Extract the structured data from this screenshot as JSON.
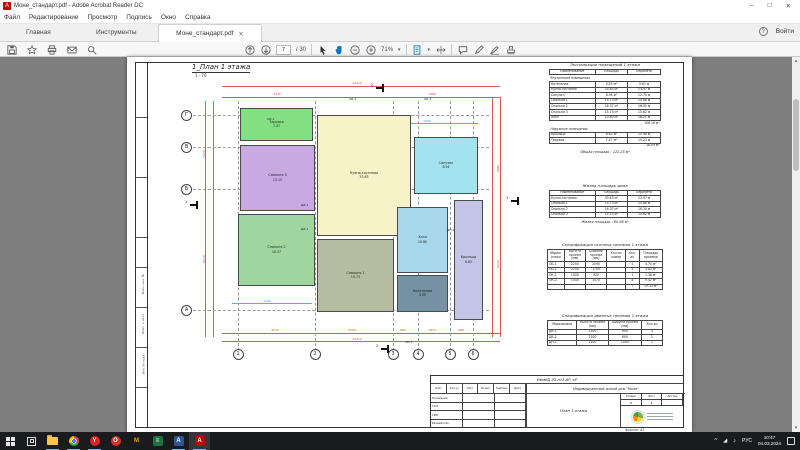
{
  "window": {
    "title": "Моне_стандарт.pdf - Adobe Acrobat Reader DC",
    "acrobat_glyph": "A",
    "controls": {
      "minimize": "–",
      "maximize": "□",
      "close": "✕"
    }
  },
  "menu": {
    "items": [
      "Файл",
      "Редактирование",
      "Просмотр",
      "Подпись",
      "Окно",
      "Справка"
    ]
  },
  "tabbar": {
    "home": "Главная",
    "tools": "Инструменты",
    "doc_tab": "Моне_стандарт.pdf",
    "close_tab": "✕",
    "help": "?",
    "sign_in": "Войти"
  },
  "toolbar": {
    "page_current": "7",
    "page_total": "/ 30",
    "zoom_level": "71%",
    "caret": "▾"
  },
  "page": {
    "title": "1_План 1 этажа",
    "scale": "1 : 70",
    "margin_labels": [
      "Взам. инв. №",
      "Подп. и дата",
      "Инв. № подл."
    ],
    "format_label": "Формат А3",
    "plan": {
      "grid_rows": [
        {
          "label": "Г",
          "y": 58
        },
        {
          "label": "В",
          "y": 90
        },
        {
          "label": "Б",
          "y": 132
        },
        {
          "label": "А",
          "y": 253
        }
      ],
      "grid_cols": [
        {
          "label": "1",
          "x": 111
        },
        {
          "label": "2",
          "x": 188
        },
        {
          "label": "3",
          "x": 266
        },
        {
          "label": "4",
          "x": 291
        },
        {
          "label": "5",
          "x": 323
        },
        {
          "label": "6",
          "x": 346
        }
      ],
      "rooms": [
        {
          "name": "Терраса",
          "area": "7.47",
          "color": "#82e082",
          "x": 113,
          "y": 51,
          "w": 73,
          "h": 33
        },
        {
          "name": "Спальня 3",
          "area": "15.15",
          "color": "#c9a9e2",
          "x": 113,
          "y": 88,
          "w": 75,
          "h": 66
        },
        {
          "name": "Спальня 2",
          "area": "16.37",
          "color": "#9fd69f",
          "x": 111,
          "y": 157,
          "w": 77,
          "h": 72
        },
        {
          "name": "Кухня-гостиная",
          "area": "33.63",
          "color": "#f7f2c8",
          "x": 190,
          "y": 58,
          "w": 94,
          "h": 121
        },
        {
          "name": "Спальня 1",
          "area": "15.73",
          "color": "#b7bda0",
          "x": 190,
          "y": 182,
          "w": 77,
          "h": 73
        },
        {
          "name": "Санузел",
          "area": "8.94",
          "color": "#a3e3ef",
          "x": 287,
          "y": 80,
          "w": 64,
          "h": 57
        },
        {
          "name": "Холл",
          "area": "10.80",
          "color": "#a8d8ec",
          "x": 270,
          "y": 150,
          "w": 51,
          "h": 66
        },
        {
          "name": "Котельная",
          "area": "5.55",
          "color": "#7691a1",
          "x": 270,
          "y": 218,
          "w": 51,
          "h": 37
        },
        {
          "name": "Крыльцо",
          "area": "8.62",
          "color": "#c5c5e8",
          "x": 327,
          "y": 143,
          "w": 29,
          "h": 120
        }
      ],
      "tags": [
        {
          "text": "ОБ-1",
          "x": 140,
          "y": 60
        },
        {
          "text": "ОБ-2",
          "x": 222,
          "y": 40
        },
        {
          "text": "ОК-2",
          "x": 297,
          "y": 40
        },
        {
          "text": "ДВ-1",
          "x": 174,
          "y": 146
        },
        {
          "text": "ДВ-1",
          "x": 174,
          "y": 170
        },
        {
          "text": "ДН-1",
          "x": 320,
          "y": 171
        },
        {
          "text": "ОК-1",
          "x": 278,
          "y": 283
        }
      ],
      "dims_top": [
        {
          "text": "12410",
          "x": 230,
          "y": 24
        },
        {
          "text": "4470",
          "x": 150,
          "y": 35
        },
        {
          "text": "7680",
          "x": 305,
          "y": 35
        }
      ],
      "dims_bottom": [
        {
          "text": "4270",
          "x": 148,
          "y": 271
        },
        {
          "text": "4190",
          "x": 225,
          "y": 271
        },
        {
          "text": "660",
          "x": 276,
          "y": 271
        },
        {
          "text": "1870",
          "x": 305,
          "y": 271
        },
        {
          "text": "660",
          "x": 334,
          "y": 271
        },
        {
          "text": "12410",
          "x": 230,
          "y": 280
        }
      ],
      "dims_left": [
        {
          "text": "5470",
          "x": 73,
          "y": 95
        },
        {
          "text": "9570",
          "x": 73,
          "y": 200
        }
      ],
      "dims_right": [
        {
          "text": "1880",
          "x": 367,
          "y": 110
        },
        {
          "text": "9130",
          "x": 367,
          "y": 205
        }
      ],
      "dims_cyan": [
        {
          "text": "1500",
          "x": 300,
          "y": 62
        },
        {
          "text": "1440",
          "x": 140,
          "y": 242
        }
      ],
      "section_markers": [
        {
          "label": "2",
          "x": 249,
          "y": 27
        },
        {
          "label": "2",
          "x": 254,
          "y": 288
        },
        {
          "label": "1",
          "x": 63,
          "y": 144
        },
        {
          "label": "1",
          "x": 384,
          "y": 140
        }
      ]
    },
    "tables": [
      {
        "id": "explication",
        "x": 422,
        "y": 6,
        "w": 112,
        "title": "Экспликация помещений 1 этажа",
        "columns": [
          "Наименование",
          "Площадь",
          "Периметр"
        ],
        "widths": [
          46,
          33,
          33
        ],
        "sections": [
          {
            "label": "Внутренние помещения",
            "rows": [
              [
                "Котельная",
                "5.55 м²",
                "9.61 м"
              ],
              [
                "Кухня-гостиная",
                "33.63 м²",
                "23.97 м"
              ],
              [
                "Санузел",
                "8.94 м²",
                "12.70 м"
              ],
              [
                "Спальня 1",
                "15.73 м²",
                "15.86 м"
              ],
              [
                "Спальня 2",
                "16.37 м²",
                "16.30 м"
              ],
              [
                "Спальня 3",
                "15.15 м²",
                "15.62 м"
              ],
              [
                "Холл",
                "10.80 м²",
                "18.21 м"
              ]
            ],
            "subtotal": "106.16 м²"
          },
          {
            "label": "Наружные помещения",
            "rows": [
              [
                "Крыльцо",
                "8.62 м²",
                "15.98 м"
              ],
              [
                "Терраса",
                "7.47 м²",
                "10.23 м"
              ]
            ],
            "subtotal": "16.09 м²"
          }
        ],
        "total_label": "Общая площадь :",
        "total_value": "122.25 м²"
      },
      {
        "id": "living",
        "x": 422,
        "y": 127,
        "w": 112,
        "title": "Жилая площадь дома",
        "columns": [
          "Наименование",
          "Площадь",
          "Периметр"
        ],
        "widths": [
          46,
          33,
          33
        ],
        "sections": [
          {
            "rows": [
              [
                "Кухня-гостиная",
                "33.63 м²",
                "23.97 м"
              ],
              [
                "Спальня 1",
                "15.73 м²",
                "15.86 м"
              ],
              [
                "Спальня 2",
                "16.37 м²",
                "16.30 м"
              ],
              [
                "Спальня 3",
                "15.15 м²",
                "15.62 м"
              ]
            ]
          }
        ],
        "total_label": "Жилая площадь :",
        "total_value": "80.88 м²"
      },
      {
        "id": "windows",
        "x": 420,
        "y": 186,
        "w": 116,
        "title": "Спецификация оконных проемов 1 этажа",
        "columns": [
          "Марки- ровка",
          "Высота проема (мм)",
          "Ширина проема (мм)",
          "Кол-во камер",
          "Кол- во",
          "Площадь проемов"
        ],
        "widths": [
          15,
          19,
          19,
          17,
          12,
          21
        ],
        "sections": [
          {
            "rows": [
              [
                "ОБ-1",
                "2250",
                "2090",
                "",
                "1",
                "4.70 м²"
              ],
              [
                "ОБ-2",
                "2250",
                "1700",
                "",
                "1",
                "3.83 м²"
              ],
              [
                "ОК-1",
                "1500",
                "920",
                "",
                "1",
                "1.38 м²"
              ],
              [
                "ОК-2",
                "1500",
                "1570",
                "",
                "4",
                "9.42 м²"
              ]
            ]
          }
        ],
        "totals_row": [
          "",
          "",
          "",
          "",
          "7",
          "19.33 м²"
        ]
      },
      {
        "id": "doors",
        "x": 420,
        "y": 257,
        "w": 116,
        "title": "Спецификация дверных проемов 1 этажа",
        "columns": [
          "Маркировка",
          "Высота проема (мм)",
          "Ширина проема (мм)",
          "Кол-во"
        ],
        "widths": [
          28,
          30,
          32,
          20
        ],
        "sections": [
          {
            "rows": [
              [
                "ДВ-1",
                "2100",
                "900",
                "3"
              ],
              [
                "ДВ-2",
                "2100",
                "800",
                "2"
              ],
              [
                "ДН-1",
                "2100",
                "1000",
                "1"
              ]
            ]
          }
        ]
      }
    ],
    "titleblock": {
      "doc_code": "ЕФмВД-03-п13-АР, кР",
      "project": "Индивидуальный жилой дом \"Моне\"",
      "sheet_name": "План 1 этажа",
      "change_header": [
        "Изм.",
        "Кол.уч",
        "Лист",
        "№ док.",
        "Подпись",
        "Дата"
      ],
      "roles": [
        "Начальник",
        "ГАП",
        "ГИП",
        "Разработал"
      ],
      "stage_label": "Стадия",
      "sheet_label": "Лист",
      "sheets_label": "Листов",
      "stage_value": "Э",
      "sheet_value": "4",
      "sheets_value": ""
    }
  },
  "taskbar": {
    "icons": [
      {
        "name": "start-button",
        "type": "win"
      },
      {
        "name": "task-view-button",
        "type": "taskview"
      },
      {
        "name": "explorer-icon",
        "type": "folder",
        "running": true
      },
      {
        "name": "chrome-icon",
        "type": "chrome",
        "running": true
      },
      {
        "name": "yandex-browser-icon",
        "type": "circle",
        "bg": "#e02020",
        "fg": "#ffffff",
        "glyph": "Y",
        "running": true
      },
      {
        "name": "red-app-icon",
        "type": "circle",
        "bg": "#d93025",
        "fg": "#ffffff",
        "glyph": "O"
      },
      {
        "name": "dark-orange-app-icon",
        "type": "circle",
        "bg": "#1d1d1d",
        "fg": "#ff9800",
        "glyph": "M"
      },
      {
        "name": "green-app-icon",
        "type": "square",
        "bg": "#1e7145",
        "fg": "#ffffff",
        "glyph": "≡"
      },
      {
        "name": "blue-app-icon",
        "type": "square",
        "bg": "#2b579a",
        "fg": "#ffffff",
        "glyph": "A",
        "running": true
      },
      {
        "name": "acrobat-icon",
        "type": "square",
        "bg": "#b30b00",
        "fg": "#ffffff",
        "glyph": "A",
        "running": true,
        "active": true
      }
    ],
    "tray": {
      "chevron": "^",
      "net": "◢",
      "snd": "♪",
      "lang": "РУС",
      "time": "10:47",
      "date": "04.03.2024"
    }
  }
}
